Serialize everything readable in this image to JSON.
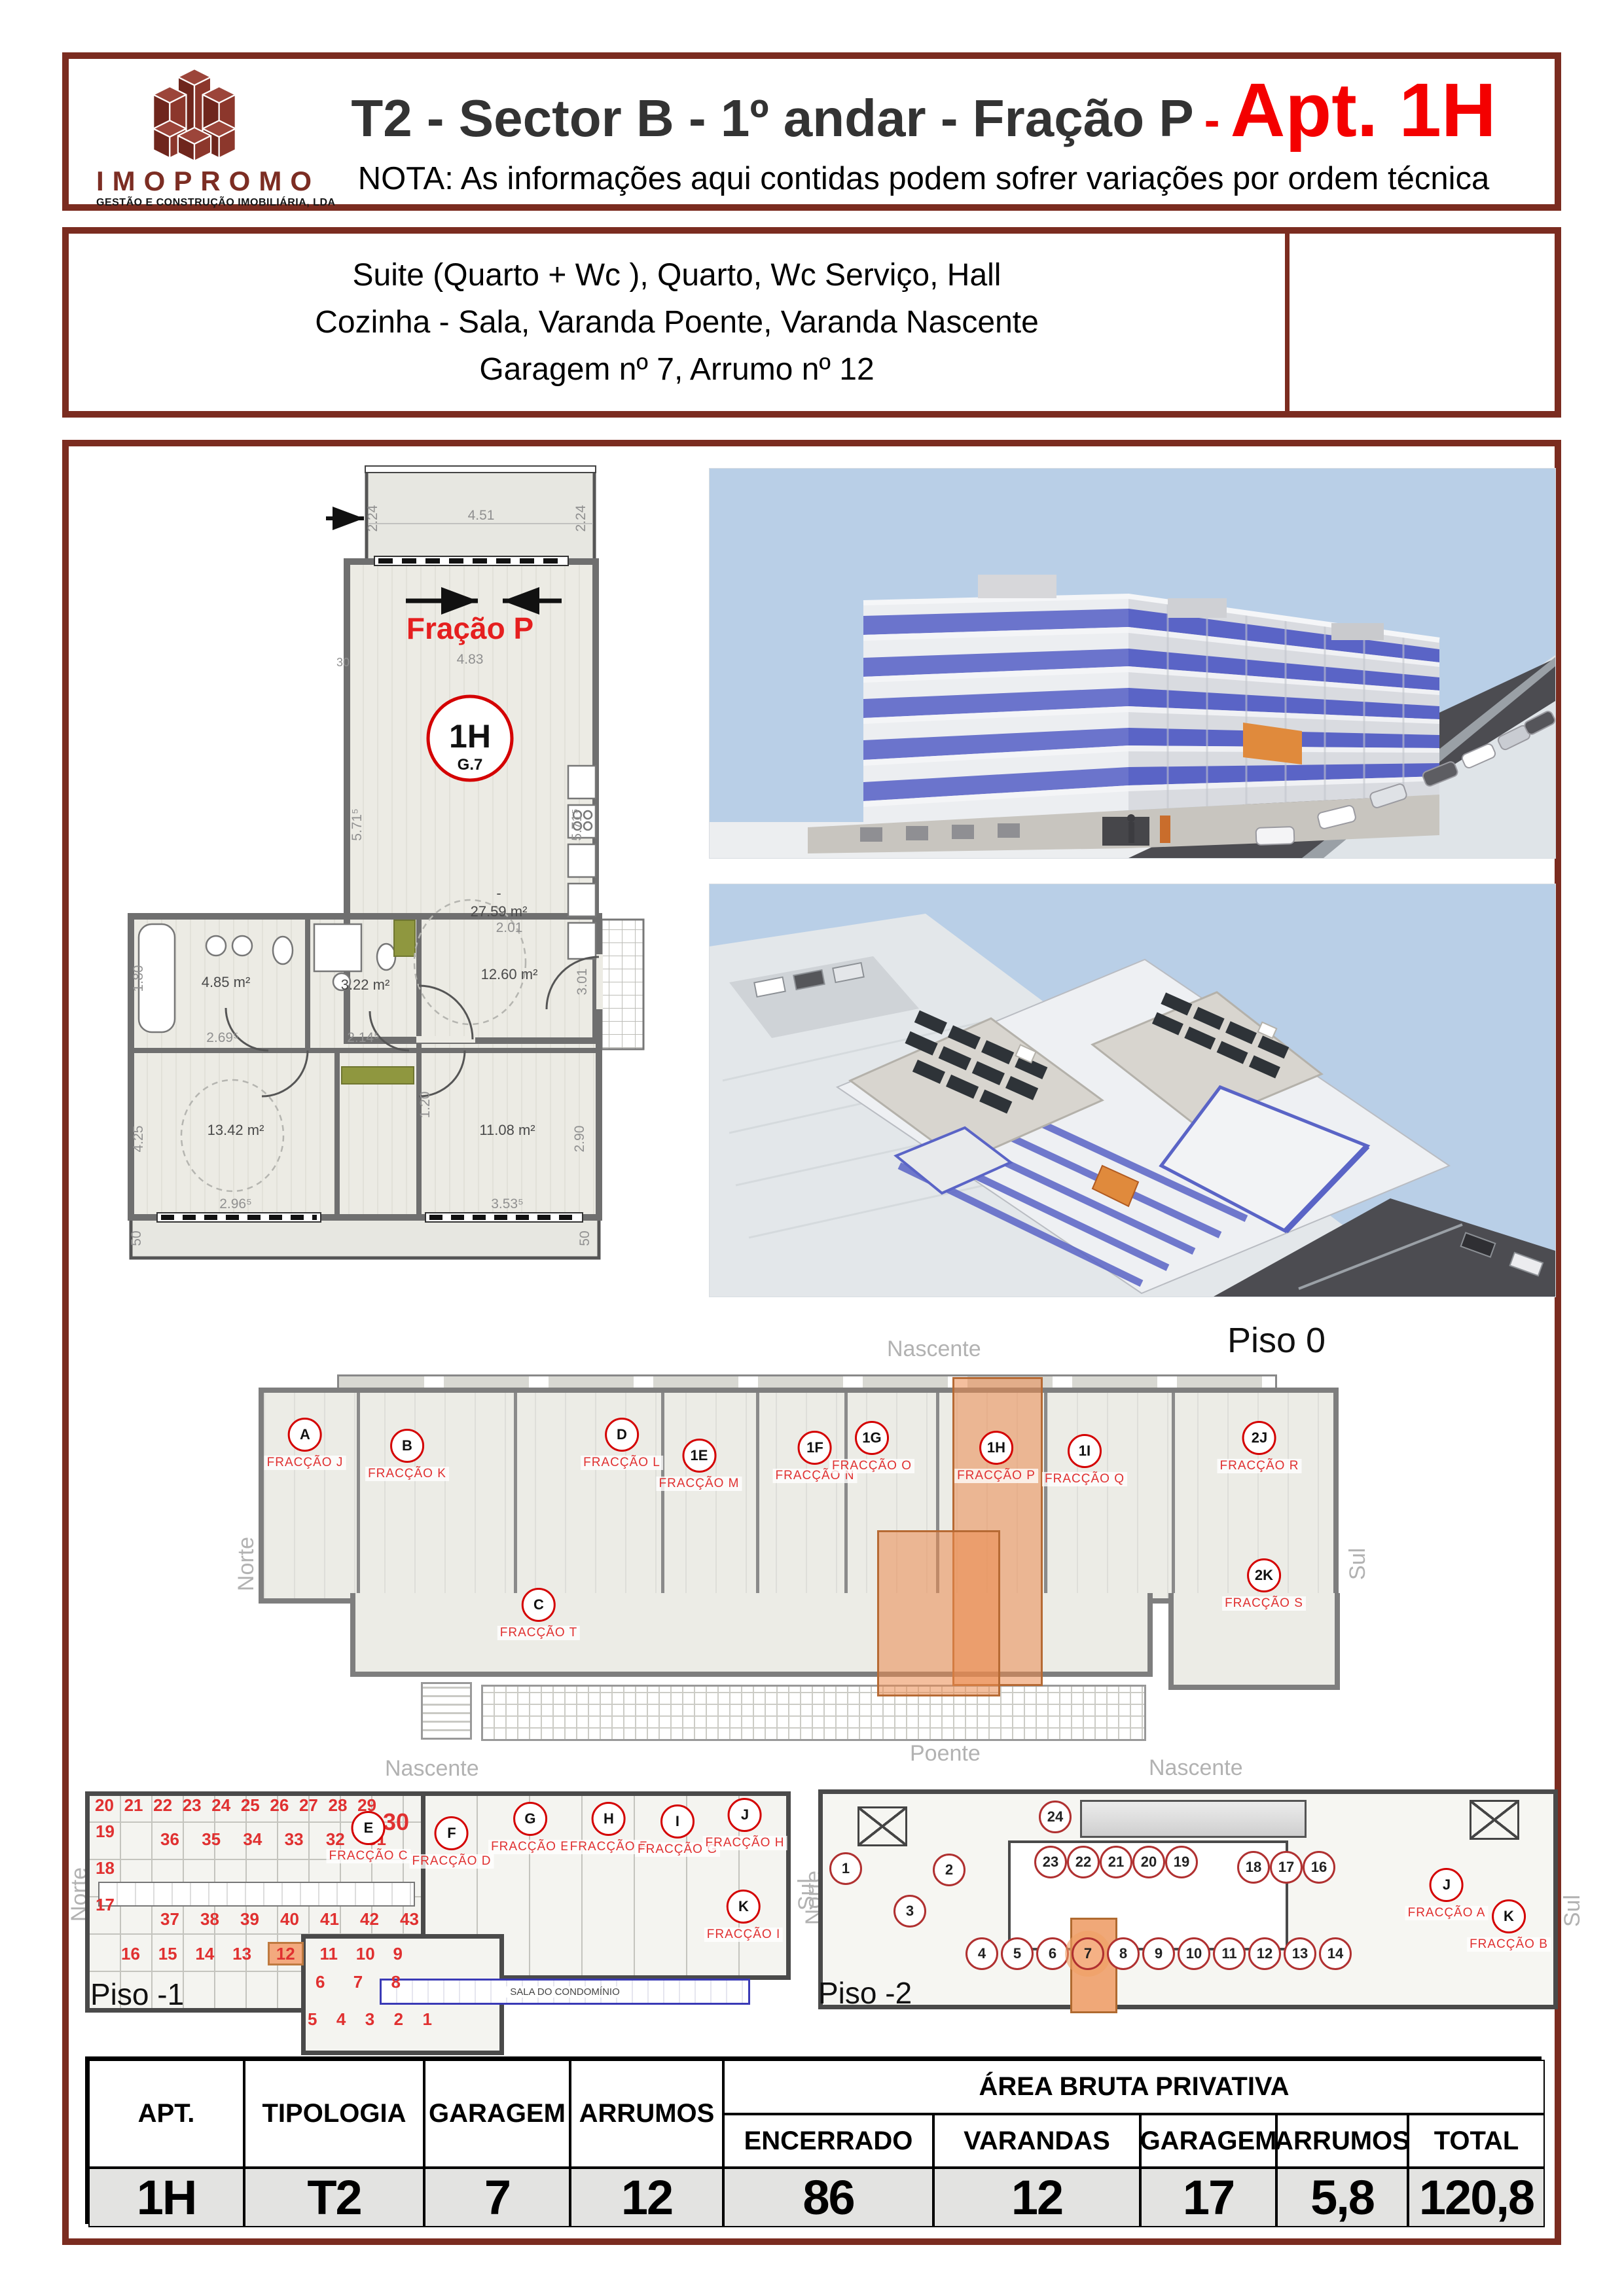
{
  "colors": {
    "frame": "#7b2c20",
    "accent_red": "#f40000",
    "label_red": "#e03030",
    "highlight_orange": "#f0a878",
    "band_blue": "#5a64c6",
    "sky": "#b9cfe7"
  },
  "header": {
    "brand": "IMOPROMO",
    "brand_tagline": "GESTÃO E CONSTRUÇÃO IMOBILIÁRIA, LDA",
    "title_main": "T2 - Sector B - 1º andar - Fração P",
    "title_dash": "-",
    "title_apt": "Apt. 1H",
    "note": "NOTA: As informações aqui contidas podem sofrer variações por ordem técnica"
  },
  "summary": {
    "lines": [
      "Suite (Quarto + Wc ), Quarto, Wc Serviço, Hall",
      "Cozinha - Sala, Varanda Poente, Varanda Nascente",
      "Garagem nº 7, Arrumo nº 12"
    ]
  },
  "apartment_plan": {
    "fraction_label": "Fração P",
    "unit_code": "1H",
    "unit_garage": "G.7",
    "areas": {
      "living": "27.59 m²",
      "bath": "4.85 m²",
      "wc": "3.22 m²",
      "hall": "12.60 m²",
      "bedroom1": "13.42 m²",
      "bedroom2": "11.08 m²"
    },
    "dims": {
      "balcony_w": "4.51",
      "balcony_d_l": "2.24",
      "balcony_d_r": "2.24",
      "wall": "30",
      "living_w": "4.83",
      "living_h_l": "5.71⁵",
      "living_h_r": "5.71⁵",
      "bath_w": "2.69⁵",
      "bath_d": "1.80",
      "wc_w": "2.14⁵",
      "hall_w": "2.01",
      "hall_h": "3.01",
      "hall_d": "1.20",
      "bd1_w": "2.96⁵",
      "bd1_h": "4.25",
      "bd2_w": "3.53⁵",
      "bd2_h": "2.90",
      "parapet_l": "50",
      "parapet_r": "50",
      "dash": "-"
    }
  },
  "piso0": {
    "label": "Piso 0",
    "compass": {
      "top": "Nascente",
      "bottom": "Poente",
      "left": "Norte",
      "right": "Sul"
    },
    "units": [
      {
        "code": "A",
        "name": "FRACÇÃO J"
      },
      {
        "code": "B",
        "name": "FRACÇÃO K"
      },
      {
        "code": "C",
        "name": "FRACÇÃO T"
      },
      {
        "code": "D",
        "name": "FRACÇÃO L"
      },
      {
        "code": "1E",
        "name": "FRACÇÃO M"
      },
      {
        "code": "1F",
        "name": "FRACÇÃO N"
      },
      {
        "code": "1G",
        "name": "FRACÇÃO O"
      },
      {
        "code": "1H",
        "name": "FRACÇÃO P"
      },
      {
        "code": "1I",
        "name": "FRACÇÃO Q"
      },
      {
        "code": "2J",
        "name": "FRACÇÃO R"
      },
      {
        "code": "2K",
        "name": "FRACÇÃO S"
      }
    ]
  },
  "piso_m1": {
    "label": "Piso -1",
    "compass": {
      "top": "Nascente",
      "bottom": "Poente",
      "left": "Norte",
      "right": "Sul"
    },
    "common_room": "SALA DO CONDOMÍNIO",
    "storage": {
      "top": [
        "20",
        "21",
        "22",
        "23",
        "24",
        "25",
        "26",
        "27",
        "28",
        "29"
      ],
      "big": "30",
      "left": [
        "19",
        "18",
        "17"
      ],
      "m1": [
        "36",
        "35",
        "34",
        "33",
        "32",
        "31"
      ],
      "m2": [
        "37",
        "38",
        "39",
        "40",
        "41",
        "42",
        "43"
      ],
      "r3": [
        "16",
        "15",
        "14",
        "13",
        "12",
        "11",
        "10",
        "9"
      ],
      "r4": [
        "6",
        "7",
        "8"
      ],
      "r5": [
        "5",
        "4",
        "3",
        "2",
        "1"
      ],
      "highlight": "12"
    },
    "units": [
      {
        "code": "E",
        "name": "FRACÇÃO C"
      },
      {
        "code": "F",
        "name": "FRACÇÃO D"
      },
      {
        "code": "G",
        "name": "FRACÇÃO E"
      },
      {
        "code": "H",
        "name": "FRACÇÃO F"
      },
      {
        "code": "I",
        "name": "FRACÇÃO G"
      },
      {
        "code": "J",
        "name": "FRACÇÃO H"
      },
      {
        "code": "K",
        "name": "FRACÇÃO I"
      }
    ]
  },
  "piso_m2": {
    "label": "Piso -2",
    "compass": {
      "top": "Nascente",
      "bottom": "Poente",
      "left": "Norte",
      "right": "Sul"
    },
    "garages": {
      "left": [
        "1",
        "2",
        "3"
      ],
      "top": "24",
      "mid": [
        "23",
        "22",
        "21",
        "20",
        "19"
      ],
      "right": [
        "18",
        "17",
        "16"
      ],
      "bottom": [
        "4",
        "5",
        "6",
        "7",
        "8",
        "9",
        "10",
        "11",
        "12",
        "13",
        "14"
      ],
      "highlight": "7"
    },
    "units": [
      {
        "code": "J",
        "name": "FRACÇÃO A"
      },
      {
        "code": "K",
        "name": "FRACÇÃO B"
      }
    ]
  },
  "table": {
    "headers": [
      "APT.",
      "TIPOLOGIA",
      "GARAGEM",
      "ARRUMOS"
    ],
    "group_header": "ÁREA BRUTA PRIVATIVA",
    "sub_headers": [
      "ENCERRADO",
      "VARANDAS",
      "GARAGEM",
      "ARRUMOS",
      "TOTAL"
    ],
    "values": [
      "1H",
      "T2",
      "7",
      "12",
      "86",
      "12",
      "17",
      "5,8",
      "120,8"
    ]
  }
}
